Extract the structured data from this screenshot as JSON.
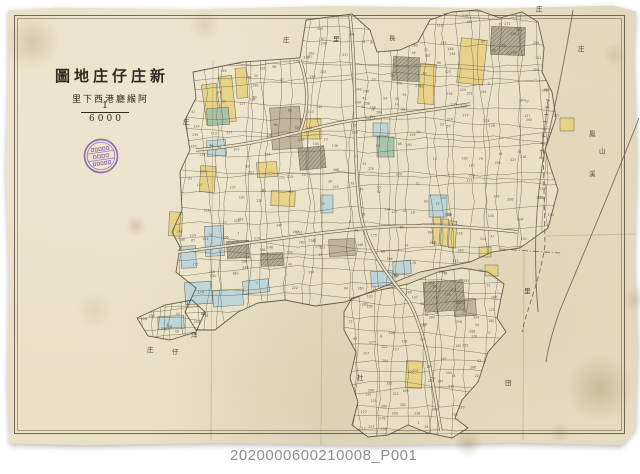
{
  "document": {
    "title_display": "圖地庄仔庄新",
    "subtitle_display": "里下西港廳緱阿",
    "scale_numerator": "1",
    "scale_denominator": "6000",
    "caption_id": "2020000600210008_P001"
  },
  "seal": {
    "color": "#7355ad"
  },
  "palette": {
    "background": "#ffffff",
    "paper": "#e9e0c6",
    "cluster_fill": "#efe7cd",
    "line": "#5a5442",
    "outline": "#4d4635",
    "frame": "#5a5240",
    "parcel_yellow": "#e7d07c",
    "parcel_blue": "#b4d4dd",
    "parcel_green": "#9cc2a8",
    "parcel_tan": "#b6ad94",
    "parcel_gray": "#aaa28a",
    "river": "#6a6350",
    "caption_text": "#8f8f8f",
    "stain": "#8a6a3e",
    "stain_pink": "#b06a6a"
  },
  "scatter_labels": [
    {
      "char": "庄",
      "x": 283,
      "y": 42
    },
    {
      "char": "里",
      "x": 333,
      "y": 41
    },
    {
      "char": "長",
      "x": 389,
      "y": 40
    },
    {
      "char": "庄",
      "x": 536,
      "y": 11
    },
    {
      "char": "庄",
      "x": 578,
      "y": 51
    },
    {
      "char": "鳳",
      "x": 589,
      "y": 136
    },
    {
      "char": "山",
      "x": 599,
      "y": 153
    },
    {
      "char": "溪",
      "x": 589,
      "y": 176
    },
    {
      "char": "里",
      "x": 524,
      "y": 293
    },
    {
      "char": "洋",
      "x": 191,
      "y": 337
    },
    {
      "char": "仔",
      "x": 172,
      "y": 354
    },
    {
      "char": "庄",
      "x": 147,
      "y": 352
    },
    {
      "char": "社",
      "x": 357,
      "y": 380
    },
    {
      "char": "庄",
      "x": 183,
      "y": 124
    },
    {
      "char": "田",
      "x": 505,
      "y": 385
    }
  ]
}
